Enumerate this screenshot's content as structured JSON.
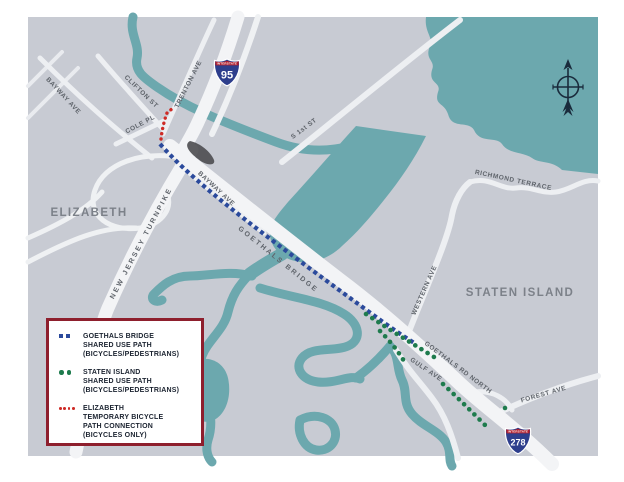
{
  "map": {
    "title_places": [
      {
        "label": "ELIZABETH"
      },
      {
        "label": "STATEN ISLAND"
      }
    ],
    "roads": [
      {
        "label": "BAYWAY AVE"
      },
      {
        "label": "CLIFTON ST"
      },
      {
        "label": "TRENTON AVE"
      },
      {
        "label": "COLE PL"
      },
      {
        "label": "S 1st ST"
      },
      {
        "label": "BAYWAY AVE"
      },
      {
        "label": "NEW JERSEY TURNPIKE"
      },
      {
        "label": "GOETHALS BRIDGE"
      },
      {
        "label": "RICHMOND TERRACE"
      },
      {
        "label": "WESTERN AVE"
      },
      {
        "label": "GOETHALS RD NORTH"
      },
      {
        "label": "GULF AVE"
      },
      {
        "label": "FOREST AVE"
      }
    ],
    "shields": [
      {
        "banner": "INTERSTATE",
        "number": "95"
      },
      {
        "banner": "INTERSTATE",
        "number": "278"
      }
    ],
    "colors": {
      "land": "#c8cbd3",
      "water": "#6ca8ae",
      "road_major": "#f3f4f6",
      "road_minor": "#e9ebef",
      "path_blue": "#2b4a9c",
      "path_green": "#1e7b4d",
      "path_red": "#ce2b26",
      "legend_border": "#8e1f2d",
      "shield_blue": "#2d3e8c",
      "shield_red": "#b01f2e",
      "compass": "#1a2b3c"
    }
  },
  "legend": {
    "items": [
      {
        "lines": [
          "GOETHALS BRIDGE",
          "SHARED USE PATH",
          "(BICYCLES/PEDESTRIANS)"
        ]
      },
      {
        "lines": [
          "STATEN ISLAND",
          "SHARED USE PATH",
          "(BICYCLES/PEDESTRIANS)"
        ]
      },
      {
        "lines": [
          "ELIZABETH",
          "TEMPORARY BICYCLE",
          "PATH CONNECTION",
          "(BICYCLES ONLY)"
        ]
      }
    ]
  }
}
